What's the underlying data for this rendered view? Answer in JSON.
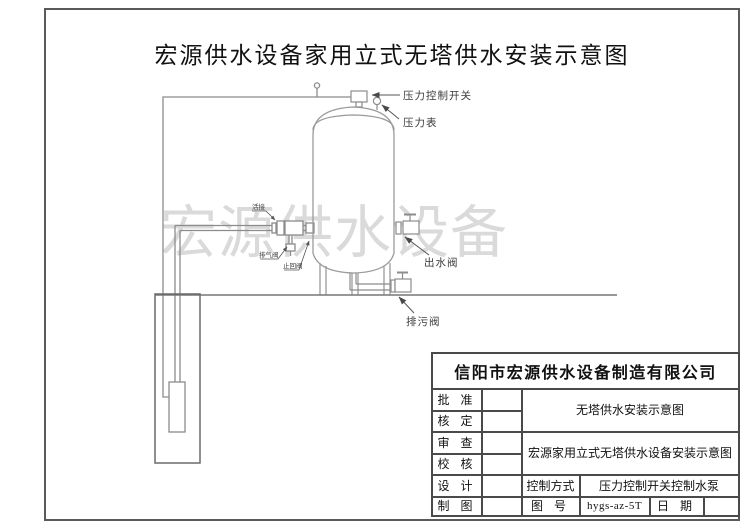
{
  "page": {
    "title": "宏源供水设备家用立式无塔供水安装示意图",
    "watermark": "宏源供水设备"
  },
  "diagram": {
    "labels": {
      "pressure_switch": "压力控制开关",
      "pressure_gauge": "压力表",
      "union": "活接",
      "air_valve": "排气阀",
      "check_valve": "止回阀",
      "outlet_valve": "出水阀",
      "drain_valve": "排污阀"
    }
  },
  "title_block": {
    "company": "信阳市宏源供水设备制造有限公司",
    "rows": [
      {
        "label": "批 准"
      },
      {
        "label": "核 定"
      },
      {
        "label": "审 查"
      },
      {
        "label": "校 核"
      },
      {
        "label": "设 计"
      },
      {
        "label": "制 图"
      }
    ],
    "doc_title_1": "无塔供水安装示意图",
    "doc_title_2": "宏源家用立式无塔供水设备安装示意图",
    "control_mode_label": "控制方式",
    "control_mode_value": "压力控制开关控制水泵",
    "drawing_no_label": "图 号",
    "drawing_no_value": "hygs-az-5T",
    "date_label": "日 期",
    "date_value": ""
  },
  "colors": {
    "frame": "#5a5a5a",
    "pipe_line": "#8c8c8c",
    "tank_line": "#9a9a9a",
    "ground_line": "#777777",
    "label_text": "#3a3a3a",
    "watermark": "#d2d2d2",
    "table_line": "#4a4a4a"
  }
}
